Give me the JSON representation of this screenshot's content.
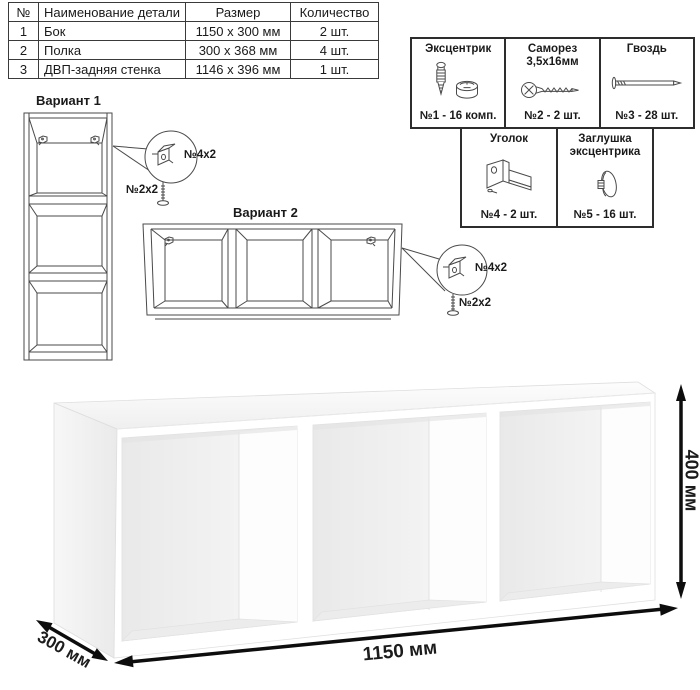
{
  "parts_table": {
    "headers": {
      "num": "№",
      "name": "Наименование детали",
      "size": "Размер",
      "qty": "Количество"
    },
    "rows": [
      {
        "num": "1",
        "name": "Бок",
        "size": "1150 x 300 мм",
        "qty": "2 шт."
      },
      {
        "num": "2",
        "name": "Полка",
        "size": "300 x 368 мм",
        "qty": "4 шт."
      },
      {
        "num": "3",
        "name": "ДВП-задняя стенка",
        "size": "1146 x 396 мм",
        "qty": "1 шт."
      }
    ]
  },
  "hardware": {
    "items": [
      {
        "title": "Эксцентрик",
        "subtitle": "",
        "count": "№1 - 16 комп.",
        "icon": "cam-fitting-icon"
      },
      {
        "title": "Саморез",
        "subtitle": "3,5х16мм",
        "count": "№2 - 2 шт.",
        "icon": "screw-icon"
      },
      {
        "title": "Гвоздь",
        "subtitle": "",
        "count": "№3 - 28 шт.",
        "icon": "nail-icon"
      },
      {
        "title": "Уголок",
        "subtitle": "",
        "count": "№4 - 2 шт.",
        "icon": "corner-bracket-icon"
      },
      {
        "title": "Заглушка",
        "subtitle": "эксцентрика",
        "count": "№5 - 16 шт.",
        "icon": "cam-cover-icon"
      }
    ]
  },
  "variants": {
    "v1": {
      "title": "Вариант 1",
      "bracket_label": "№4х2",
      "screw_label": "№2х2",
      "bracket_icon": "corner-bracket-icon",
      "screw_icon": "screw-icon"
    },
    "v2": {
      "title": "Вариант 2",
      "bracket_label": "№4х2",
      "screw_label": "№2х2",
      "bracket_icon": "corner-bracket-icon",
      "screw_icon": "screw-icon"
    }
  },
  "dimensions": {
    "width": "1150 мм",
    "height": "400 мм",
    "depth": "300 мм"
  },
  "colors": {
    "line_art": "#4a4a4a",
    "arrow": "#0d0d0d",
    "table_border": "#3a3a3a",
    "hardware_border": "#2d2d2d"
  }
}
